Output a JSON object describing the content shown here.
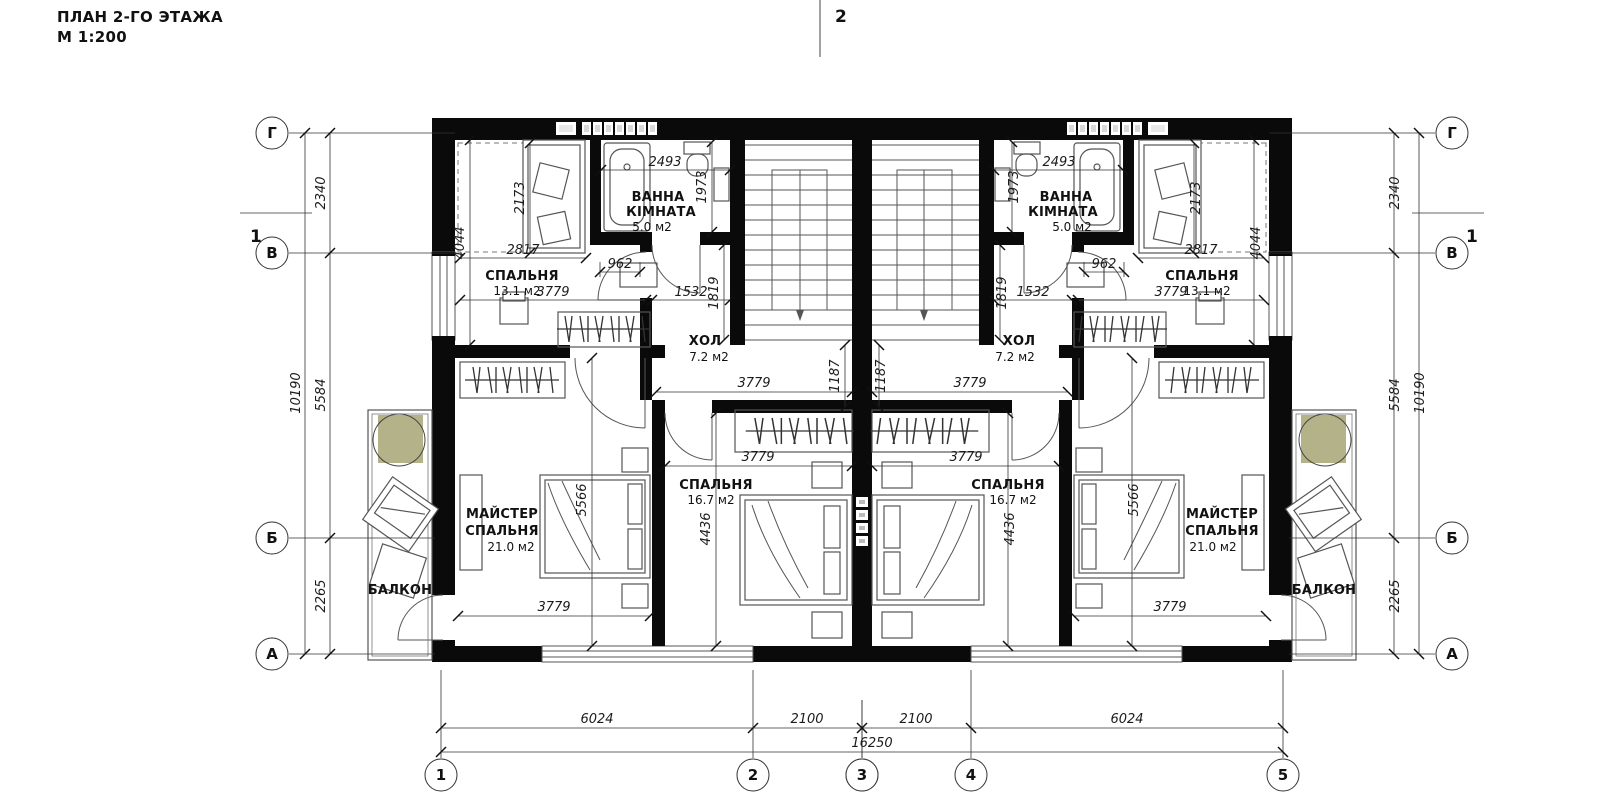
{
  "title": {
    "line1": "ПЛАН 2-ГО ЭТАЖА",
    "line2": "М 1:200"
  },
  "section_markers": {
    "top": "2",
    "side": "1"
  },
  "axis_rows": {
    "g": "Г",
    "v": "В",
    "b": "Б",
    "a": "А"
  },
  "axis_cols": {
    "c1": "1",
    "c2": "2",
    "c3": "3",
    "c4": "4",
    "c5": "5"
  },
  "rooms": {
    "bedroom_small": {
      "name": "СПАЛЬНЯ",
      "area": "13.1 м2"
    },
    "bathroom": {
      "name_line1": "ВАННА",
      "name_line2": "КІМНАТА",
      "area": "5.0 м2"
    },
    "hall": {
      "name": "ХОЛ",
      "area": "7.2 м2"
    },
    "bedroom_mid": {
      "name": "СПАЛЬНЯ",
      "area": "16.7 м2"
    },
    "master_bedroom": {
      "name_line1": "МАЙСТЕР",
      "name_line2": "СПАЛЬНЯ",
      "area": "21.0 м2"
    },
    "balcony": {
      "name": "БАЛКОН"
    }
  },
  "dims": {
    "d2340": "2340",
    "d10190": "10190",
    "d5584": "5584",
    "d2265": "2265",
    "d2173": "2173",
    "d4044": "4044",
    "d2817": "2817",
    "d3779": "3779",
    "d962": "962",
    "d1532": "1532",
    "d1819": "1819",
    "d2493": "2493",
    "d1973": "1973",
    "d1187": "1187",
    "d4436": "4436",
    "d5566": "5566",
    "d6024": "6024",
    "d2100": "2100",
    "d16250": "16250"
  },
  "colors": {
    "wall": "#0a0a0a",
    "line": "#444444",
    "tree": "#b3b289",
    "paper": "#ffffff"
  }
}
